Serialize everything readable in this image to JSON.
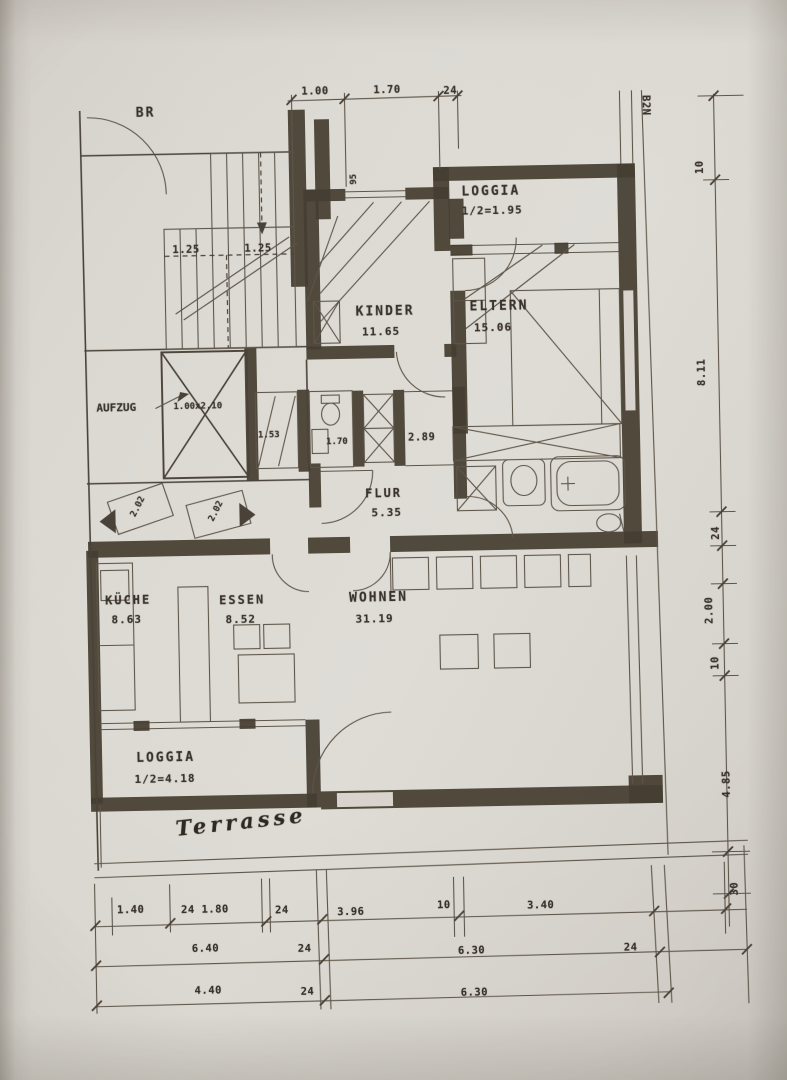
{
  "colors": {
    "paper": "#d8d4cd",
    "ink": "#4a4238",
    "wall": "#463d31"
  },
  "annotations": {
    "br": "BR",
    "b2n": "B2N",
    "window_width": "95",
    "terrasse": "Terrasse"
  },
  "rooms": {
    "loggia_top": {
      "name": "LOGGIA",
      "area": "1/2=1.95"
    },
    "kinder": {
      "name": "KINDER",
      "area": "11.65"
    },
    "eltern": {
      "name": "ELTERN",
      "area": "15.06"
    },
    "aufzug": {
      "name": "AUFZUG",
      "size": "1.00x2.10"
    },
    "flur": {
      "name": "FLUR",
      "area": "5.35"
    },
    "kueche": {
      "name": "KÜCHE",
      "area": "8.63"
    },
    "essen": {
      "name": "ESSEN",
      "area": "8.52"
    },
    "wohnen": {
      "name": "WOHNEN",
      "area": "31.19"
    },
    "loggia_bottom": {
      "name": "LOGGIA",
      "area": "1/2=4.18"
    }
  },
  "small_dims": {
    "stairs_left": "1.25",
    "stairs_right": "1.25",
    "niche": "1.53",
    "wc": "1.70",
    "storage": "2.89",
    "door_left": "2.02",
    "door_right": "2.02"
  },
  "dims": {
    "top": [
      "1.00",
      "1.70",
      "24"
    ],
    "right": [
      "10",
      "8.11",
      "24",
      "2.00",
      "10",
      "4.85",
      "30"
    ],
    "b1": [
      "1.40",
      "24 1.80",
      "24",
      "3.96",
      "10",
      "3.40"
    ],
    "b2": [
      "6.40",
      "24",
      "6.30",
      "24"
    ],
    "b3": [
      "4.40",
      "24",
      "6.30"
    ]
  }
}
